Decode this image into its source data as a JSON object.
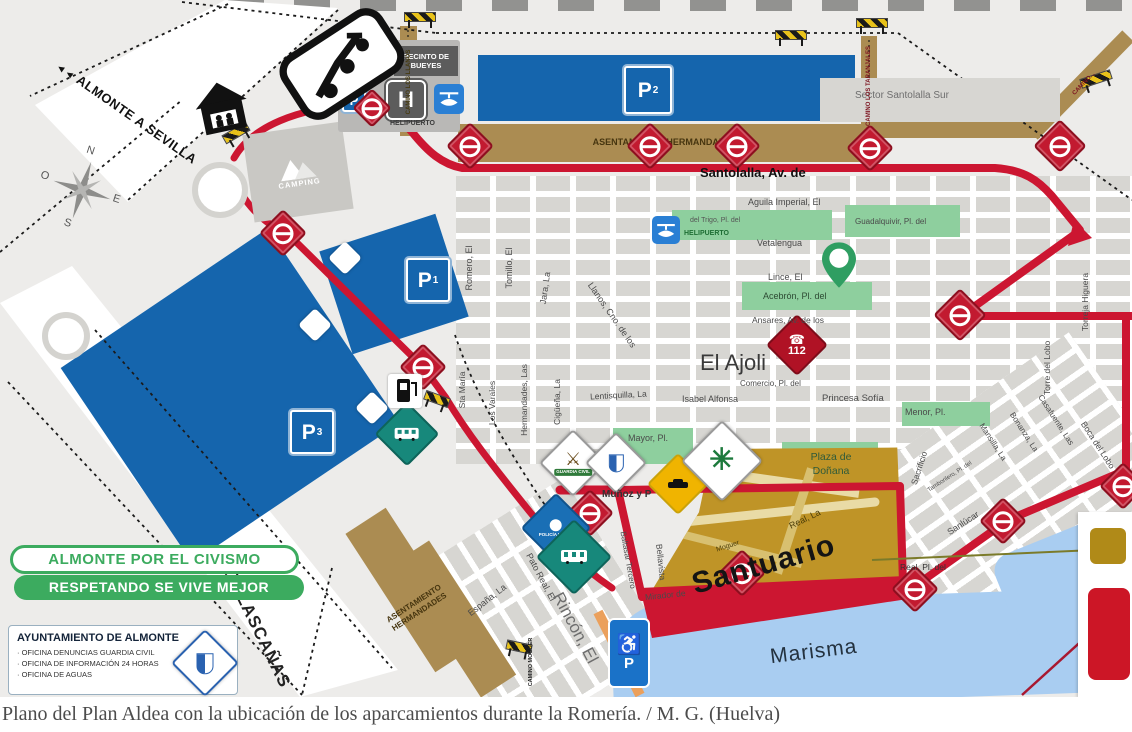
{
  "caption": "Plano del Plan Aldea con la ubicación de los aparcamientos durante la Romería. / M. G. (Huelva)",
  "colors": {
    "parking_blue": "#1565ad",
    "road_red": "#cc1631",
    "camino_brown": "#ab8c52",
    "green_area": "#8ecf9e",
    "santuario_gold": "#bf9427",
    "water_blue": "#a9cdf1",
    "civismo_green": "#3cab5f",
    "checkpoint_red": "#c21a30"
  },
  "signs": {
    "parking_letter": "P",
    "p1_sub": "1",
    "p2_sub": "2",
    "p3_sub": "3",
    "hospital": "H",
    "emergency_number": "112",
    "helipuerto_top": "HELIPUERTO",
    "helipuerto_center": "HELIPUERTO",
    "recinto": "RECINTO DE BUEYES",
    "policia": "POLICÍA LOCAL",
    "guardia": "GUARDIA CIVIL",
    "almonte_sevilla": "ALMONTE A SEVILLA",
    "arrows": "◄◄"
  },
  "areas": {
    "camping": "CAMPING",
    "asentamiento_top": "ASENTAMIENTO HERMANDADES",
    "asentamiento_bottom": "ASENTAMIENTO HERMANDADES",
    "sector": "Sector Santolalla Sur",
    "plaza_donana": "Plaza de Doñana",
    "santuario": "Santuario",
    "marisma": "Marisma",
    "el_ajoli": "El Ajoli"
  },
  "caminos": {
    "llanos": "CAMINO LOS LLANOS",
    "taranjales": "CAMINO LOS TARANJALES",
    "right": "CAMINO...",
    "moguer": "CAMINO MOGUER"
  },
  "streets": {
    "santolalla": "Santolalla, Av. de",
    "aguila": "Aguila Imperial, El",
    "guadalquivir": "Guadalquivir, Pl. del",
    "vetalengua": "Vetalengua",
    "lince": "Lince, El",
    "acebron": "Acebrón, Pl. del",
    "ansares": "Ansares, Av. de los",
    "trigo": "del Trigo, Pl. del",
    "comercio": "Comercio, Pl. del",
    "isabel": "Isabel Alfonsa",
    "princesa": "Princesa Sofía",
    "menor": "Menor, Pl.",
    "romero": "Romero, El",
    "tomillo": "Tomillo, El",
    "jara": "Jara, La",
    "llanos_cno": "Llanos, Cno. de los",
    "sta_maria": "Sta María",
    "varales": "Los Varales",
    "hermandades": "Hermandades, Las",
    "ciguena": "Cigüeña, La",
    "lentisquilla": "Lentisquilla, La",
    "mayor": "Mayor, Pl.",
    "munoz": "Muñoz y P",
    "real_la": "Real, La",
    "moguer": "Moguer",
    "real_pl": "Real, Pl. del",
    "sacrificio": "Sacrificio",
    "tamborilero": "Tamborilero, Pl. del",
    "sanlucar": "Sanlúcar",
    "torre_lobo": "Torre del Lobo",
    "torreja": "Torreja Higuera",
    "boca": "Boca del Lobo",
    "mansilla": "Mansilla, La",
    "bonanza": "Bonanza, La",
    "casafuente": "Casafuente, Las",
    "baltasar": "Baltasar Tercero",
    "bellavista": "Bellavista",
    "mirador": "Mirador de",
    "espana": "España, La",
    "pato": "Pato Real, El",
    "rincon": "Rincón, El"
  },
  "banner": {
    "line1": "ALMONTE POR EL CIVISMO",
    "line2": "RESPETANDO SE VIVE MEJOR"
  },
  "ayuntamiento": {
    "title": "AYUNTAMIENTO DE ALMONTE",
    "line1": "· OFICINA DENUNCIAS GUARDIA CIVIL",
    "line2": "· OFICINA DE INFORMACIÓN 24 HORAS",
    "line3": "· OFICINA DE AGUAS"
  },
  "matalascanas": "MATALASCAÑAS"
}
